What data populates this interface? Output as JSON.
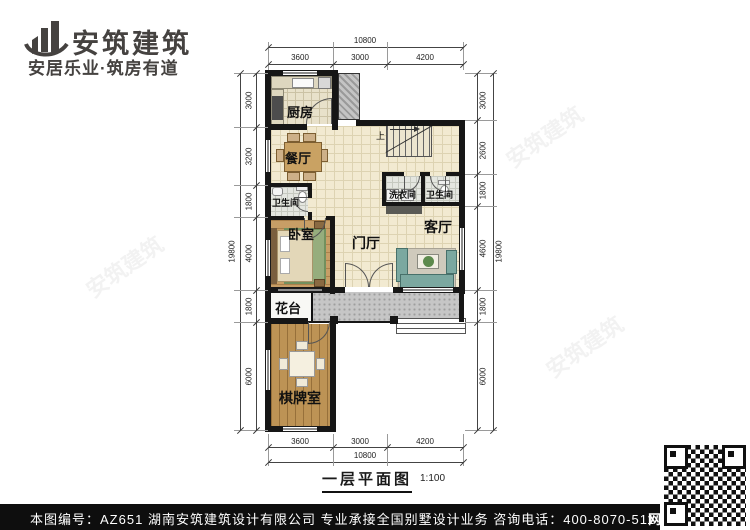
{
  "header": {
    "brand": "安筑建筑",
    "slogan": "安居乐业·筑房有道"
  },
  "plan": {
    "rooms": {
      "kitchen": "厨房",
      "dining": "餐厅",
      "bath_left": "卫生间",
      "laundry": "洗衣间",
      "bath_right": "卫生间",
      "bedroom": "卧室",
      "foyer": "门厅",
      "living": "客厅",
      "flower_bed": "花台",
      "game_room": "棋牌室"
    },
    "stairs_label": "上",
    "dimensions": {
      "top_total": "10800",
      "top_segments": [
        "3600",
        "3000",
        "4200"
      ],
      "bottom_segments": [
        "3600",
        "3000",
        "4200"
      ],
      "bottom_total": "10800",
      "left_total": "19800",
      "left_segments": [
        "3000",
        "3200",
        "1800",
        "4000",
        "1800",
        "6000"
      ],
      "right_segments": [
        "3000",
        "2600",
        "1800",
        "4600",
        "1800",
        "6000"
      ],
      "right_total": "19800"
    }
  },
  "caption": {
    "title": "一层平面图",
    "scale": "1:100"
  },
  "footer": {
    "drawing_number": "本图编号：AZ651",
    "company_line": "湖南安筑建筑设计有限公司  专业承接全国别墅设计业务  咨询电话：400-8070-511",
    "web_char": "网"
  },
  "colors": {
    "brand_text": "#454240",
    "wall": "#161616",
    "floor_tile": "#f2ead1",
    "wood": "#c49a63",
    "terrace": "#c6c6c6",
    "footer_bg": "#0e0e0e"
  }
}
